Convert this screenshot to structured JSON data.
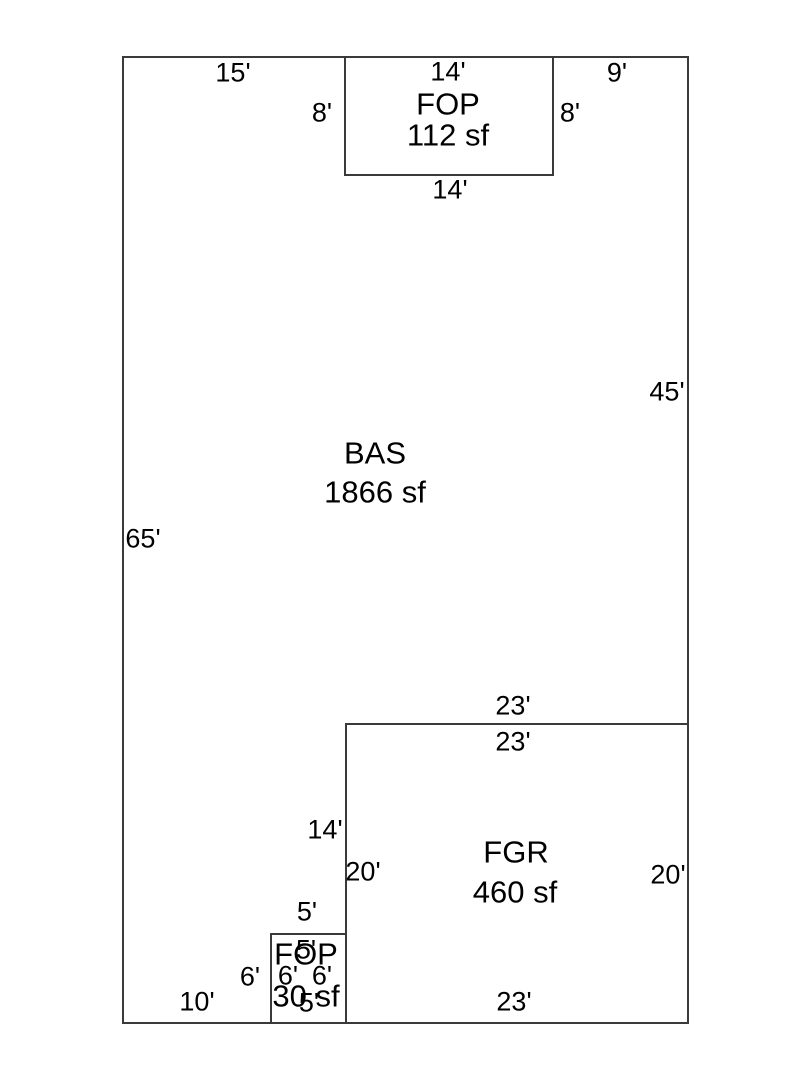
{
  "figure": {
    "width": 810,
    "height": 1080,
    "background_color": "#ffffff",
    "line_color": "#3a3a3a",
    "text_color": "#000000",
    "type": "floor-plan-sketch"
  },
  "sketch": {
    "outline": {
      "x": 123,
      "y": 57,
      "w": 565,
      "h": 966
    },
    "rooms": [
      {
        "name": "BAS",
        "area": "1866 sf",
        "name_pos": {
          "x": 375,
          "y": 453
        },
        "area_pos": {
          "x": 375,
          "y": 492
        },
        "rect": null
      },
      {
        "name": "FOP",
        "area": "112 sf",
        "name_pos": {
          "x": 448,
          "y": 104
        },
        "area_pos": {
          "x": 448,
          "y": 135
        },
        "rect": {
          "x": 345,
          "y": 57,
          "w": 208,
          "h": 118
        }
      },
      {
        "name": "FGR",
        "area": "460 sf",
        "name_pos": {
          "x": 516,
          "y": 852
        },
        "area_pos": {
          "x": 515,
          "y": 892
        },
        "rect": {
          "x": 346,
          "y": 724,
          "w": 342,
          "h": 299
        }
      },
      {
        "name": "FOP",
        "area": "30 sf",
        "name_pos": {
          "x": 306,
          "y": 954
        },
        "area_pos": {
          "x": 306,
          "y": 996
        },
        "rect": {
          "x": 271,
          "y": 934,
          "w": 75,
          "h": 89
        }
      }
    ],
    "dimensions": [
      {
        "text": "15'",
        "x": 233,
        "y": 73
      },
      {
        "text": "14'",
        "x": 448,
        "y": 72
      },
      {
        "text": "9'",
        "x": 617,
        "y": 73
      },
      {
        "text": "8'",
        "x": 322,
        "y": 113
      },
      {
        "text": "8'",
        "x": 570,
        "y": 113
      },
      {
        "text": "14'",
        "x": 450,
        "y": 190
      },
      {
        "text": "45'",
        "x": 667,
        "y": 392
      },
      {
        "text": "65'",
        "x": 143,
        "y": 539
      },
      {
        "text": "23'",
        "x": 513,
        "y": 706
      },
      {
        "text": "23'",
        "x": 513,
        "y": 742
      },
      {
        "text": "14'",
        "x": 325,
        "y": 830
      },
      {
        "text": "20'",
        "x": 363,
        "y": 872
      },
      {
        "text": "20'",
        "x": 668,
        "y": 875
      },
      {
        "text": "5'",
        "x": 307,
        "y": 912
      },
      {
        "text": "6'",
        "x": 250,
        "y": 977
      },
      {
        "text": "6'",
        "x": 288,
        "y": 976
      },
      {
        "text": "6'",
        "x": 322,
        "y": 976
      },
      {
        "text": "5'",
        "x": 306,
        "y": 950
      },
      {
        "text": "5'",
        "x": 309,
        "y": 1003
      },
      {
        "text": "10'",
        "x": 197,
        "y": 1002
      },
      {
        "text": "23'",
        "x": 514,
        "y": 1002
      }
    ]
  }
}
